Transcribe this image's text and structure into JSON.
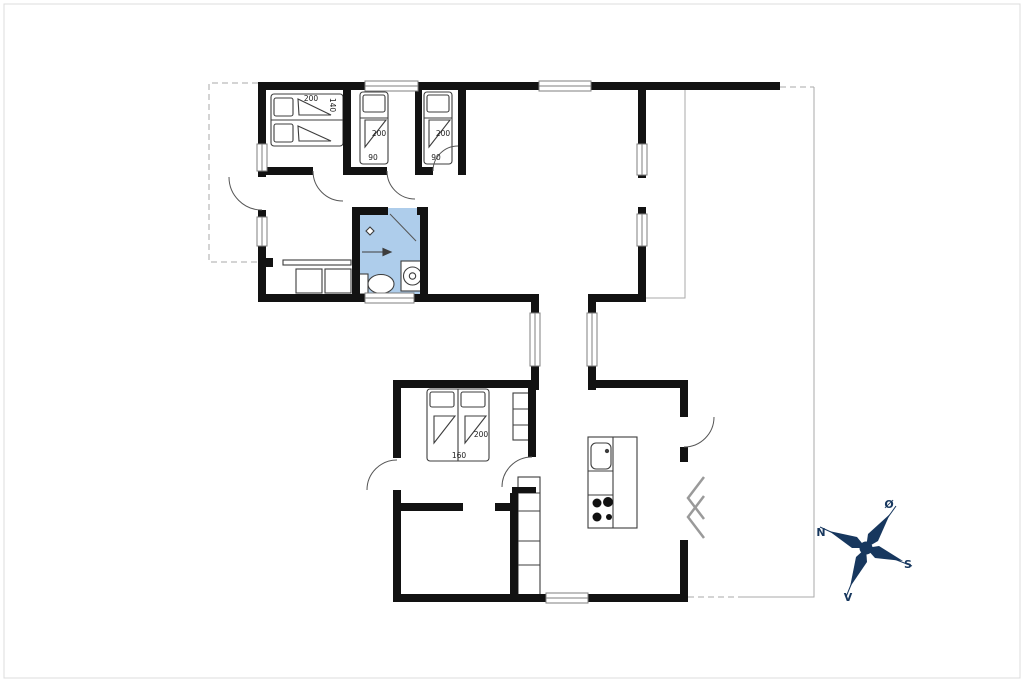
{
  "plan": {
    "kind": "floor-plan",
    "beds": {
      "bedroom1_double": {
        "length": "200",
        "width": "140"
      },
      "bedroom2_single": {
        "length": "200",
        "width": "90"
      },
      "bedroom3_single": {
        "length": "200",
        "width": "90"
      },
      "bedroom4_double": {
        "length": "200",
        "width": "160"
      }
    },
    "compass": {
      "north_label": "N",
      "east_label": "Ø",
      "south_label": "S",
      "west_label": "V"
    },
    "colors": {
      "wall": "#121212",
      "bathroom_fill": "#aecdeb",
      "window_stroke": "#7f7f7f",
      "thin_outline": "#aaaaaa",
      "door_arc": "#555555",
      "fixture": "#3d3d3d",
      "zigzag": "#9a9a9a",
      "text": "#1c1c1c",
      "frame": "#dcdcdc",
      "compass_navy": "#17375e",
      "compass_gray": "#8a99ad"
    }
  }
}
